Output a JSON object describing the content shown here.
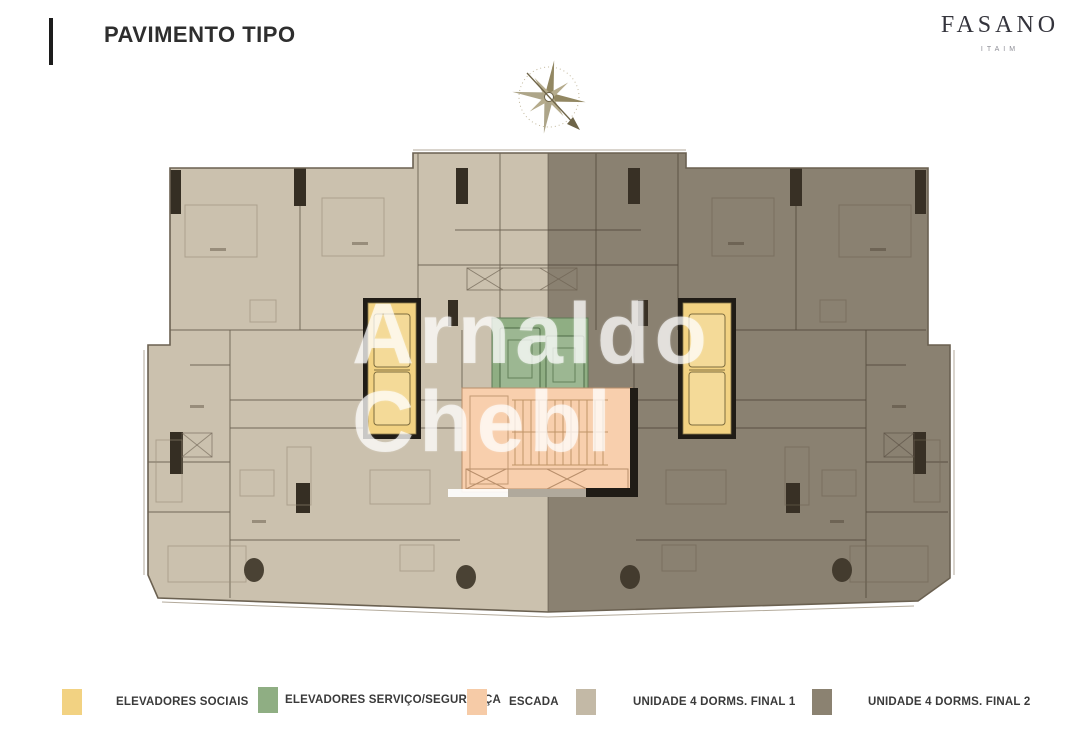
{
  "header": {
    "title": "PAVIMENTO TIPO"
  },
  "brand": {
    "name": "FASANO",
    "location": "ITAIM"
  },
  "watermark": {
    "line1": "Arnaldo",
    "line2": "Chebl"
  },
  "legend": {
    "items": [
      {
        "label": "ELEVADORES SOCIAIS",
        "color": "#f2d282"
      },
      {
        "label": "ELEVADORES SERVIÇO/SEGURANÇA",
        "color": "#8fae83"
      },
      {
        "label": "ESCADA",
        "color": "#f6cba7"
      },
      {
        "label": "UNIDADE 4 DORMS. FINAL 1",
        "color": "#c3b9a6"
      },
      {
        "label": "UNIDADE 4 DORMS. FINAL 2",
        "color": "#8b8271"
      }
    ]
  },
  "colors": {
    "unit1": "#cbc1ae",
    "social": "#f2d282",
    "service": "#8fae83",
    "escada": "#f8cfad",
    "wall": "#6e6353",
    "column": "#352e23",
    "outline": "#6b6151",
    "compass": "#928762"
  }
}
